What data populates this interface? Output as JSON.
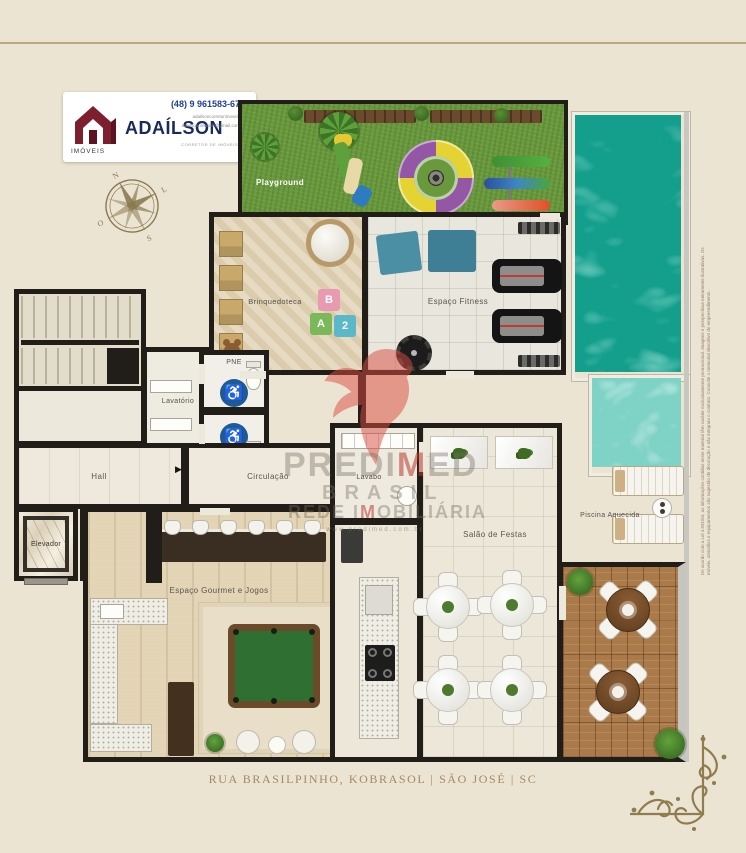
{
  "logo": {
    "brand": "ADAÍLSON",
    "tagline": "IMÓVEIS",
    "phone": "(48) 9 961583-67",
    "instagram": "adailsoncorretorimoveis",
    "email": "adailson.imoveis@gmail.com",
    "subtext": "CORRETOR DE IMÓVEIS"
  },
  "rooms": {
    "playground": "Playground",
    "brinquedoteca": "Brinquedoteca",
    "fitness": "Espaço Fitness",
    "lavatorio": "Lavatório",
    "pne_top": "PNE",
    "pne_bottom": "PNE",
    "hall": "Hall",
    "circulacao": "Circulação",
    "elevador_esq": "Elevador",
    "elevador_dir": "Elevador",
    "gourmet": "Espaço Gourmet e Jogos",
    "lavabo": "Lavabo",
    "salao": "Salão de Festas",
    "piscina": "Piscina Aquecida"
  },
  "icons": {
    "wheelchair": "♿",
    "arrow_right": "▶",
    "whatsapp": "✆",
    "instagram": "◉",
    "email": "✉"
  },
  "watermark": {
    "p1": "PREDI",
    "p2": "M",
    "p3": "ED",
    "line2": "BRASIL",
    "p4": "REDE I",
    "p5": "M",
    "p6": "OBILIÁRIA",
    "url": "www.predimed.com.br"
  },
  "compass": {
    "n": "N",
    "e": "L",
    "s": "S",
    "w": "O"
  },
  "footer": {
    "address": "RUA BRASILPINHO, KOBRASOL | SÃO JOSÉ | SC"
  },
  "disclaimer": "De acordo com a Lei 4.591/64, as informações contidas neste material têm caráter exclusivamente promocional. Imagens e perspectivas meramente ilustrativas. Os móveis, utensílios e equipamentos são sugestão de decoração e não integram o contrato. Consulte o memorial descritivo do empreendimento.",
  "colors": {
    "background": "#ece4d3",
    "wall": "#211e1a",
    "grass": "#69993c",
    "pool_deep": "#149f8d",
    "pool_shallow": "#7fd2c6",
    "accent_red": "#ba382e",
    "brand_navy": "#1b2a5c",
    "brand_maroon": "#7d1f2e",
    "footer_text": "#a5885f"
  }
}
